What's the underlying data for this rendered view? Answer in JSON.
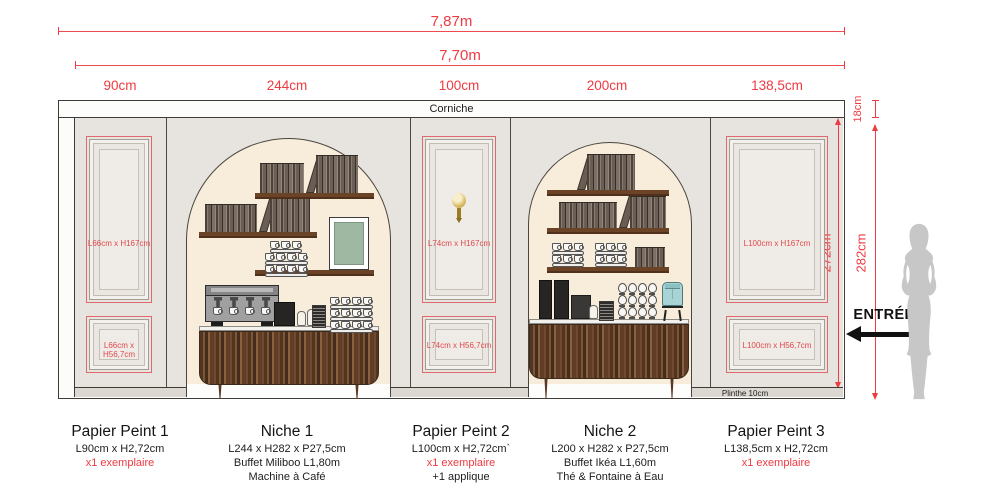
{
  "dims": {
    "total": "7,87m",
    "inner": "7,70m",
    "seg1": "90cm",
    "seg2": "244cm",
    "seg3": "100cm",
    "seg4": "200cm",
    "seg5": "138,5cm",
    "corniche_h": "18cm",
    "wall_h": "282cm",
    "panel_h": "272cm"
  },
  "wall": {
    "corniche": "Corniche",
    "plinthe": "Plinthe 10cm"
  },
  "panels": {
    "pp1_top": "L66cm x H167cm",
    "pp1_bottom": "L66cm x H56,7cm",
    "pp2_top": "L74cm x H167cm",
    "pp2_bottom": "L74cm x H56,7cm",
    "pp3_top": "L100cm x H167cm",
    "pp3_bottom": "L100cm x H56,7cm"
  },
  "entrance": "ENTRÉE",
  "legend": {
    "pp1": {
      "title": "Papier Peint 1",
      "size": "L90cm x H2,72cm",
      "count": "x1 exemplaire"
    },
    "niche1": {
      "title": "Niche 1",
      "size": "L244 x H282 x P27,5cm",
      "item1": "Buffet Miliboo L1,80m",
      "item2": "Machine à Café"
    },
    "pp2": {
      "title": "Papier Peint 2",
      "size": "L100cm x H2,72cm`",
      "count": "x1 exemplaire",
      "extra": "+1 applique"
    },
    "niche2": {
      "title": "Niche 2",
      "size": "L200 x H282 x P27,5cm",
      "item1": "Buffet Ikéa L1,60m",
      "item2": "Thé & Fontaine à Eau"
    },
    "pp3": {
      "title": "Papier Peint 3",
      "size": "L138,5cm x H2,72cm",
      "count": "x1 exemplaire"
    }
  },
  "colors": {
    "dimension_red": "#ee3a41",
    "panel_outline_red": "#dd6a6e",
    "wall_beige": "#e7e3de",
    "niche_cream": "#f8eddb",
    "shelf_wood": "#6b4326",
    "buffet_wood": "#5f3d26",
    "frame_green": "#9eb8a1",
    "dispenser_teal": "#a9d4d6",
    "silhouette_gray": "#c7c7c7"
  }
}
